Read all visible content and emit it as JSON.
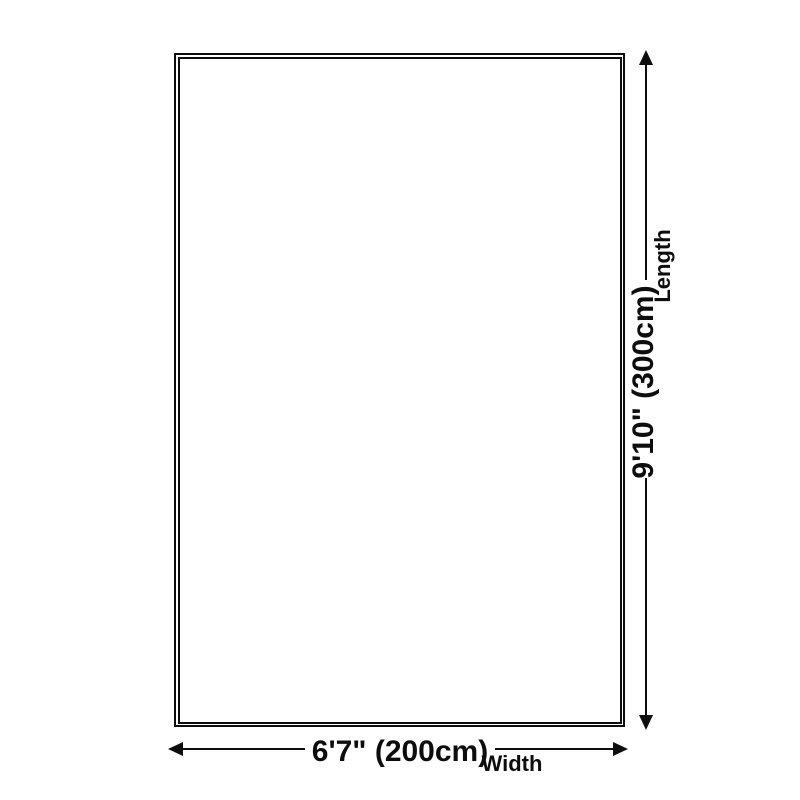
{
  "diagram": {
    "type": "product-dimension-diagram",
    "background_color": "#ffffff",
    "line_color": "#0d0d0d",
    "shape": "rectangle",
    "length": {
      "dimension": "9'10\" (300cm)",
      "axis": "Length"
    },
    "width": {
      "dimension": "6'7\" (200cm)",
      "axis": "Width"
    }
  }
}
